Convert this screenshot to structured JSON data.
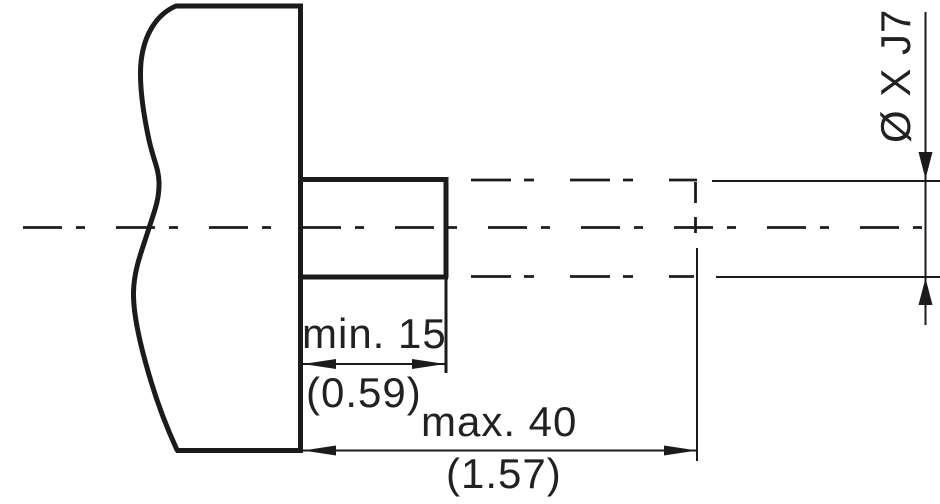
{
  "drawing": {
    "kind": "shaft-end-dimension-drawing",
    "dimensions": {
      "pilot_length": {
        "metric": "min. 15",
        "imperial": "(0.59)"
      },
      "overall_length": {
        "metric": "max. 40",
        "imperial": "(1.57)"
      },
      "bore_diameter": {
        "label": "Ø X J7"
      }
    },
    "colors": {
      "line": "#1b1b1b",
      "text": "#232021",
      "background": "#ffffff"
    }
  }
}
